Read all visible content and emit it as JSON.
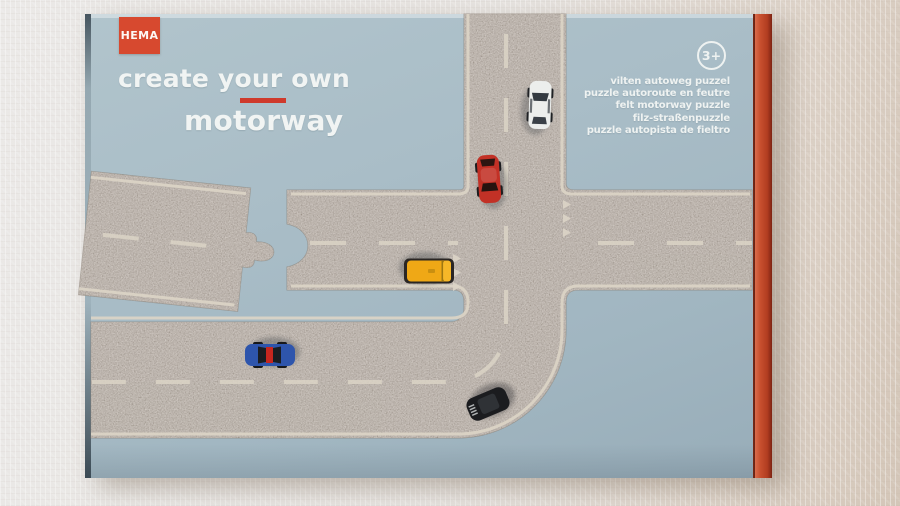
{
  "product_box": {
    "brand": "HEMA",
    "title_line1": "create your own",
    "title_line2": "motorway",
    "age_badge": "3+",
    "languages": [
      "vilten autoweg puzzel",
      "puzzle autoroute en feutre",
      "felt motorway puzzle",
      "filz-straßenpuzzle",
      "puzzle autopista de fieltro"
    ]
  },
  "cars": {
    "white": {
      "label": "white car",
      "color": "#eceeec"
    },
    "red": {
      "label": "red car",
      "color": "#c23126"
    },
    "yellow": {
      "label": "yellow van",
      "color": "#efa816"
    },
    "blue": {
      "label": "blue car",
      "color": "#2e55ac"
    },
    "black": {
      "label": "black car",
      "color": "#1b1c1f"
    }
  },
  "colors": {
    "box_face_blue": "#a7bcc6",
    "box_side_red": "#c2492c",
    "accent_red": "#cf3a2c",
    "road_felt": "#a49b92",
    "road_markings": "#dbd4c6",
    "background_cloth": "#e8e5e2"
  }
}
